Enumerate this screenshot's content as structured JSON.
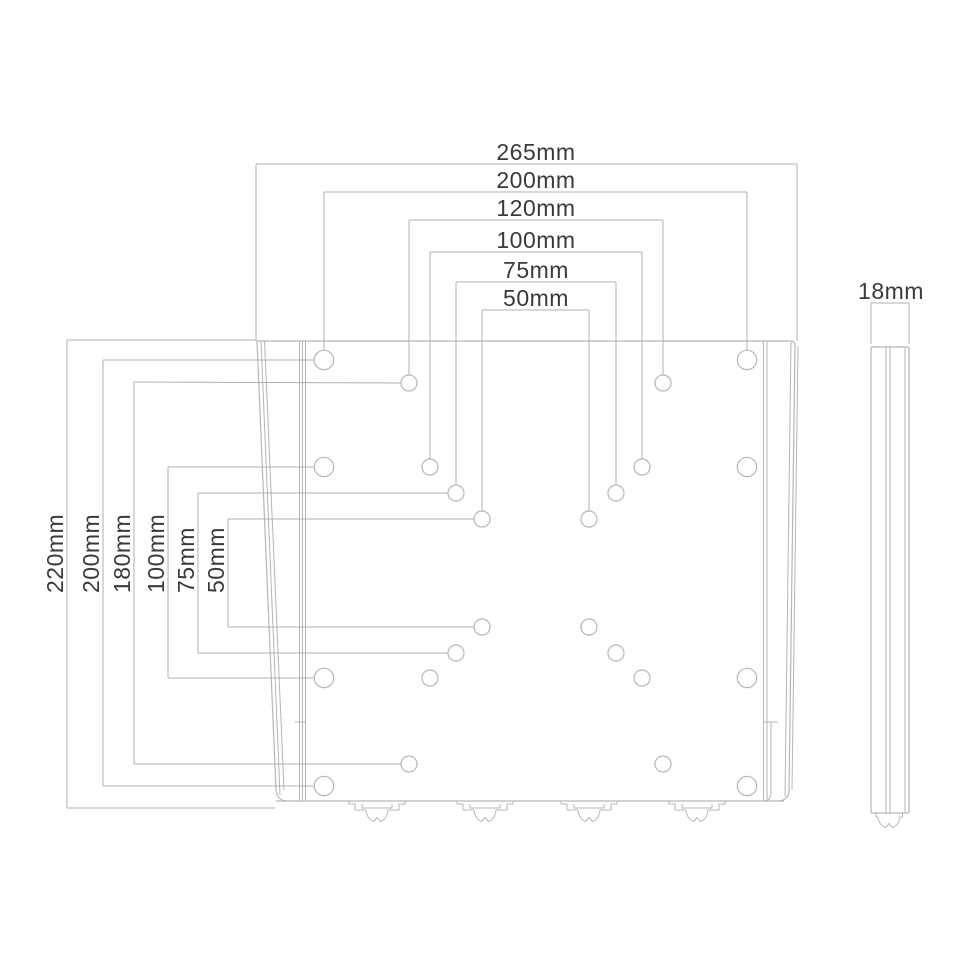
{
  "diagram": {
    "title": "wall-mount bracket dimension drawing",
    "views": {
      "front_view": "mounting plate with VESA hole patterns",
      "side_view": "plate profile"
    },
    "dimensions": {
      "top": [
        "265mm",
        "200mm",
        "120mm",
        "100mm",
        "75mm",
        "50mm"
      ],
      "left": [
        "220mm",
        "200mm",
        "180mm",
        "100mm",
        "75mm",
        "50mm"
      ],
      "side": "18mm"
    },
    "colors": {
      "background": "#ffffff",
      "line": "#b6b6b6",
      "dim_line": "#b0b0b0",
      "text": "#3a3a3a"
    }
  }
}
